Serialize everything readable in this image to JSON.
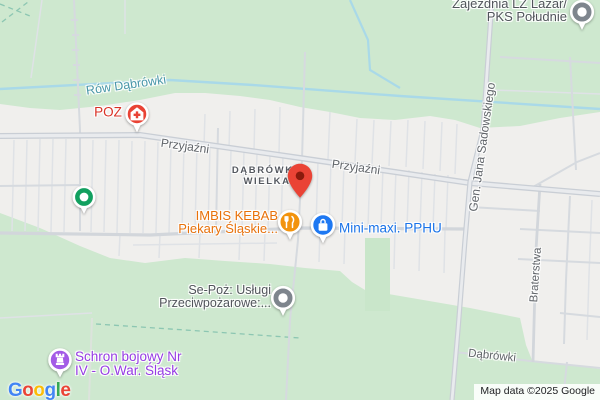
{
  "map_type": "google-map",
  "water": {
    "name": "Rów Dąbrówki"
  },
  "streets": {
    "przyjazni": "Przyjaźni",
    "sadowskiego": "Gen. Jana Sadowskiego",
    "braterstwa": "Braterstwa",
    "dabrowki": "Dąbrówki"
  },
  "locality": {
    "line1": "DĄBRÓWKA",
    "line2": "WIELKA"
  },
  "pois": {
    "poz": {
      "label": "POZ",
      "icon": "medical-pin"
    },
    "zajezdnia": {
      "line1": "Zajezdnia LZ Lazar/",
      "line2": "PKS Południe",
      "icon": "poi-dot"
    },
    "imbis": {
      "line1": "IMBIS KEBAB",
      "line2": "Piekary Śląskie...",
      "icon": "restaurant-pin"
    },
    "minimaxi": {
      "label": "Mini-maxi. PPHU",
      "icon": "shopping-pin"
    },
    "sepoz": {
      "line1": "Se-Poż: Usługi",
      "line2": "Przeciwpożarowe:...",
      "icon": "poi-dot"
    },
    "schron": {
      "line1": "Schron bojowy Nr",
      "line2": "IV - O.War. Śląsk",
      "icon": "fortress-pin"
    }
  },
  "markers": {
    "destination_pin": "red destination pin near Dąbrówka Wielka"
  },
  "footer": {
    "logo": [
      "G",
      "o",
      "o",
      "g",
      "l",
      "e"
    ],
    "attribution": "Map data ©2025 Google"
  },
  "colors": {
    "land": "#f0efed",
    "park": "#cee8cf",
    "water": "#a9d9e8",
    "road_minor": "#d6dadf",
    "road_main_casing": "#c9ced5",
    "road_main_fill": "#e9ebee",
    "water_label": "#4796a8",
    "street_label": "#5f6368",
    "locality_label": "#54585f",
    "medical_text": "#d93025",
    "medical_icon": "#e94335",
    "restaurant_text": "#e8710a",
    "restaurant_icon": "#f2930d",
    "shopping_text": "#1a73e8",
    "shopping_icon": "#1e78f2",
    "attraction_text": "#963be4",
    "attraction_icon": "#a35be6",
    "poi_gray_icon": "#7e858d",
    "poi_gray_text": "#50545a",
    "pin_red": "#ea4335",
    "pin_red_inner": "#8a1a0c",
    "marker_green": "#12a05f",
    "logo_colors": [
      "#4285F4",
      "#EA4335",
      "#FBBC05",
      "#4285F4",
      "#34A853",
      "#EA4335"
    ]
  }
}
